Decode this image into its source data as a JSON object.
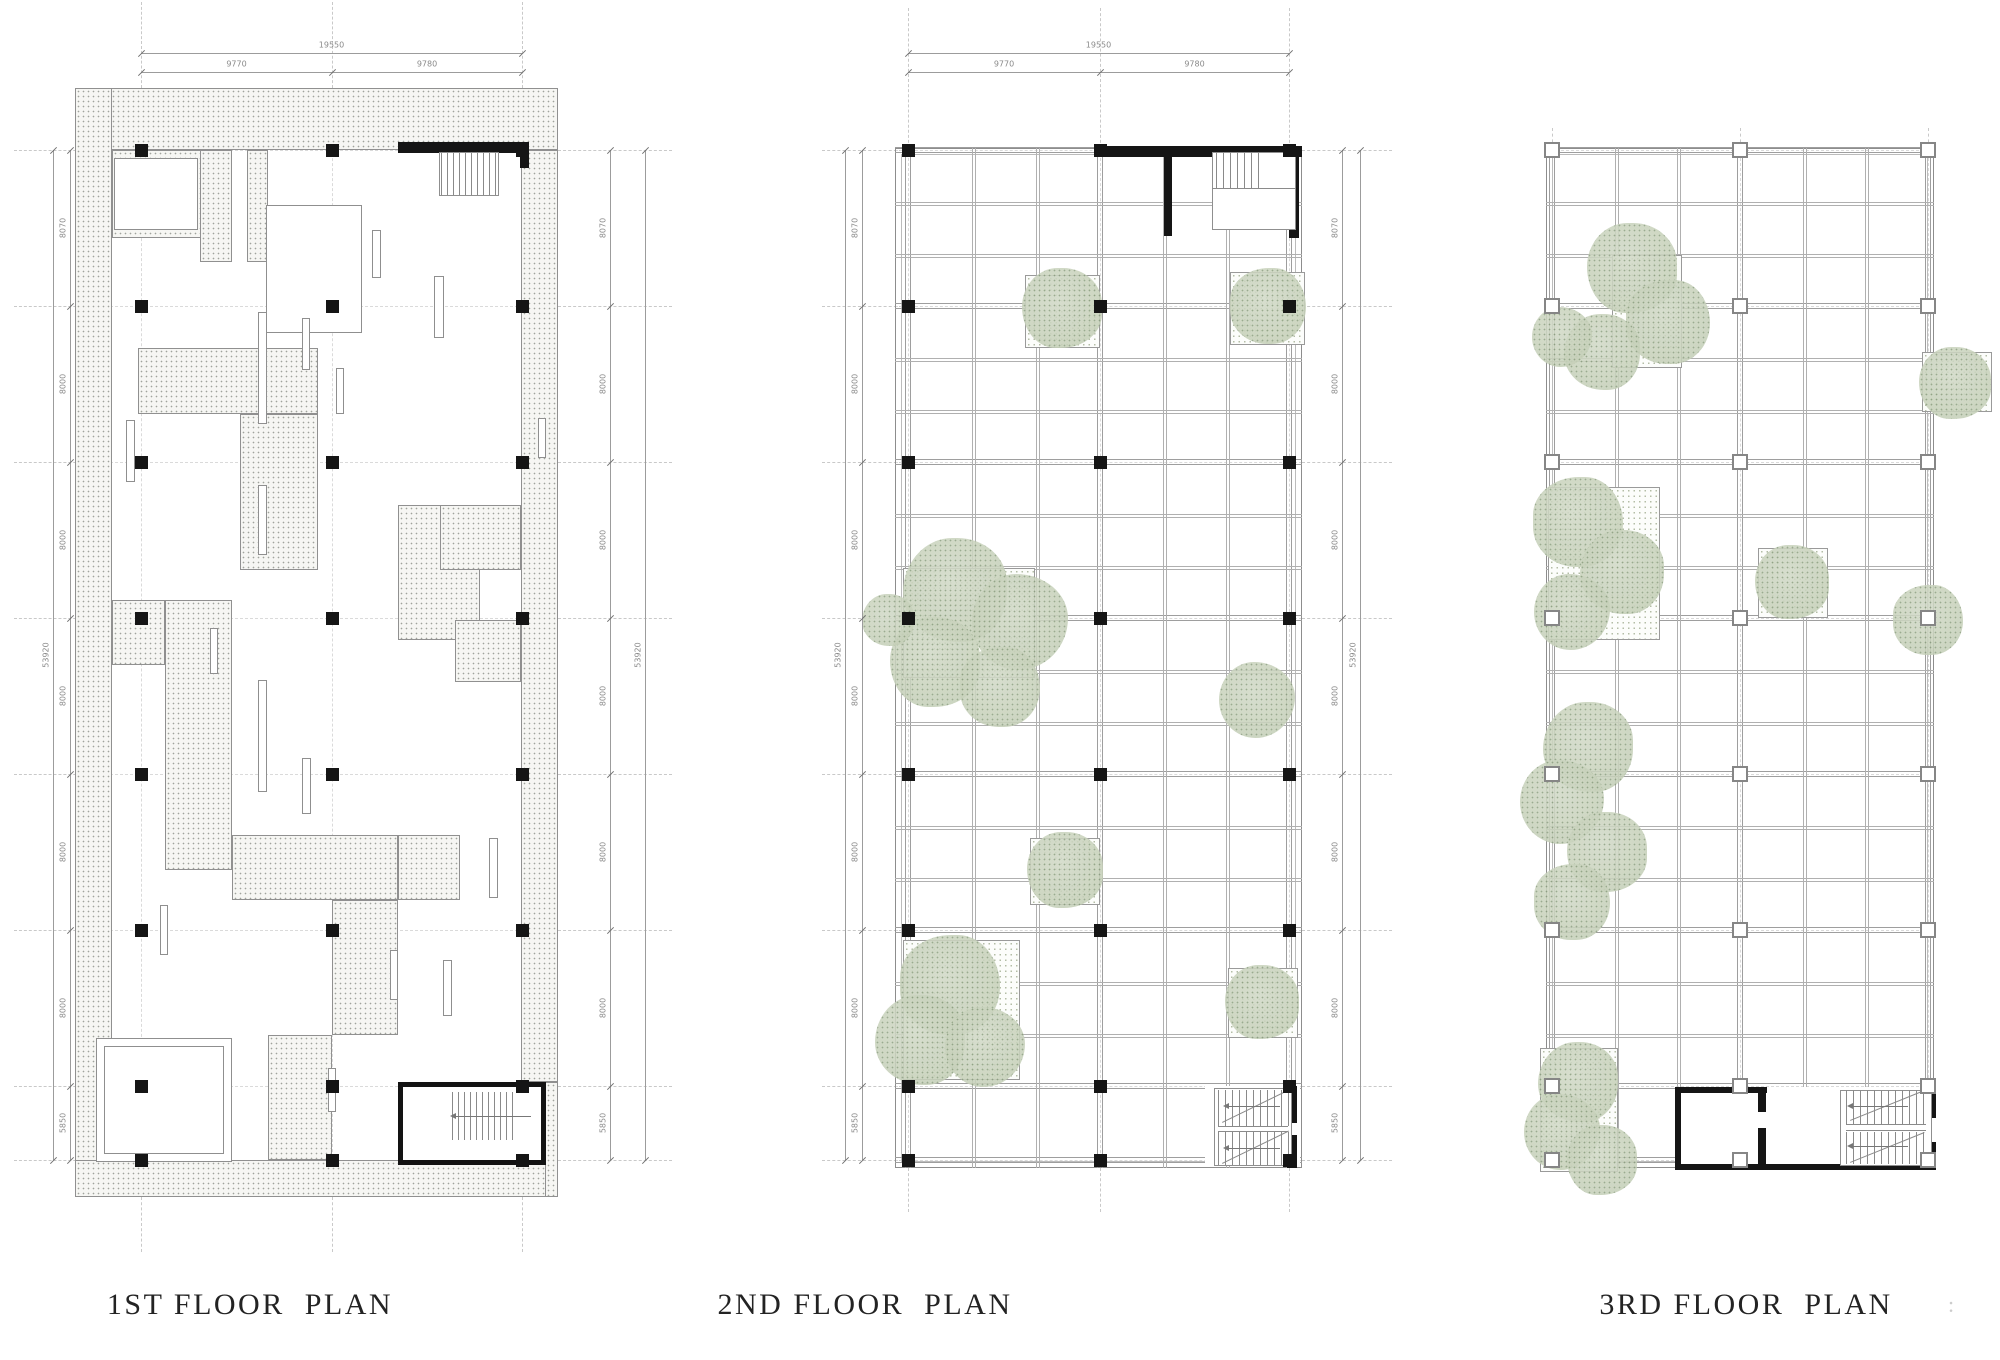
{
  "titles": {
    "first": "1ST FLOOR  PLAN",
    "second": "2ND FLOOR  PLAN",
    "third": "3RD FLOOR  PLAN"
  },
  "suffix": ":",
  "dims": {
    "top_total": "19550",
    "top_segments": [
      "9770",
      "9780"
    ],
    "side_total": "53920",
    "side_segments": [
      "8070",
      "8000",
      "8000",
      "8000",
      "8000",
      "8000",
      "5850"
    ]
  },
  "colors": {
    "line": "#9c9c9c",
    "beam": "#9e9e9e",
    "beam_light": "#b0b0b0",
    "dash": "#c9c9c9",
    "dash_inner": "#dadada",
    "dim_text": "#8a8a8a",
    "black": "#151515",
    "stair": "#8a8a8a",
    "tree_fill": "#c9d3bc",
    "tree_dot": "#8da081",
    "title": "#232323"
  },
  "geometry": {
    "rows": [
      150,
      306,
      462,
      618,
      774,
      930,
      1086,
      1160
    ],
    "plans": [
      {
        "name": "first-floor",
        "cols": [
          141,
          332,
          522
        ],
        "bld": [
          75,
          88,
          483,
          1109
        ],
        "style": "stipple",
        "colStyle": "solid",
        "topDims": true,
        "chains": [
          {
            "x": 53,
            "type": "total"
          },
          {
            "x": 70,
            "type": "chain"
          },
          {
            "x": 610,
            "type": "chain"
          },
          {
            "x": 645,
            "type": "total"
          }
        ],
        "rowDashL": [
          14,
          96
        ],
        "rowDashR": [
          558,
          672
        ],
        "colDashT": [
          2,
          88
        ],
        "colDashB": [
          1197,
          1252
        ],
        "stipple": [
          [
            75,
            88,
            483,
            62
          ],
          [
            75,
            88,
            37,
            1109
          ],
          [
            75,
            1160,
            483,
            37
          ],
          [
            521,
            150,
            37,
            932
          ],
          [
            112,
            150,
            93,
            88
          ],
          [
            200,
            150,
            32,
            112
          ],
          [
            247,
            150,
            21,
            112
          ],
          [
            138,
            348,
            180,
            66
          ],
          [
            240,
            414,
            78,
            156
          ],
          [
            398,
            505,
            82,
            135
          ],
          [
            440,
            505,
            81,
            65
          ],
          [
            165,
            600,
            67,
            270
          ],
          [
            112,
            600,
            53,
            65
          ],
          [
            232,
            835,
            166,
            65
          ],
          [
            332,
            900,
            66,
            135
          ],
          [
            398,
            835,
            62,
            65
          ],
          [
            455,
            620,
            66,
            62
          ],
          [
            268,
            1035,
            64,
            125
          ],
          [
            545,
            1082,
            13,
            115
          ]
        ],
        "rooms": [
          [
            114,
            158,
            84,
            72
          ],
          [
            266,
            205,
            96,
            128
          ],
          [
            96,
            1038,
            136,
            124
          ],
          [
            104,
            1046,
            120,
            108
          ]
        ],
        "slots": [
          [
            126,
            420,
            9,
            62
          ],
          [
            258,
            312,
            9,
            112
          ],
          [
            258,
            485,
            9,
            70
          ],
          [
            258,
            680,
            9,
            112
          ],
          [
            302,
            758,
            9,
            56
          ],
          [
            372,
            230,
            9,
            48
          ],
          [
            434,
            276,
            10,
            62
          ],
          [
            210,
            628,
            8,
            46
          ],
          [
            336,
            368,
            8,
            46
          ],
          [
            489,
            838,
            9,
            60
          ],
          [
            443,
            960,
            9,
            56
          ],
          [
            328,
            1068,
            8,
            44
          ],
          [
            160,
            905,
            8,
            50
          ],
          [
            390,
            950,
            8,
            50
          ],
          [
            538,
            418,
            8,
            40
          ],
          [
            302,
            318,
            8,
            52
          ]
        ],
        "black": [
          [
            398,
            142,
            131,
            11
          ],
          [
            520,
            142,
            9,
            26
          ]
        ],
        "stairRooms": [
          [
            398,
            1082,
            148,
            83
          ]
        ],
        "stairOutlines": [
          [
            439,
            152,
            60,
            44
          ]
        ],
        "treads": [
          {
            "x": 441,
            "y": 153,
            "w": 54,
            "h": 42,
            "step": 6
          },
          {
            "x": 452,
            "y": 1092,
            "w": 64,
            "h": 48,
            "step": 6
          }
        ],
        "arrows": [
          [
            455,
            1116,
            76
          ]
        ]
      },
      {
        "name": "second-floor",
        "cols": [
          908,
          1100,
          1289
        ],
        "bld": [
          895,
          148,
          407,
          1020
        ],
        "style": "frame",
        "colStyle": "solid",
        "topDims": true,
        "chains": [
          {
            "x": 845,
            "type": "total"
          },
          {
            "x": 862,
            "type": "chain"
          },
          {
            "x": 1342,
            "type": "chain"
          },
          {
            "x": 1360,
            "type": "total"
          }
        ],
        "rowDashL": [
          822,
          902
        ],
        "rowDashR": [
          1302,
          1392
        ],
        "colDashT": [
          8,
          148
        ],
        "colDashB": [
          1168,
          1212
        ],
        "whiteBase": [
          [
            1205,
            1086,
            95,
            80
          ]
        ],
        "black": [
          [
            1096,
            146,
            206,
            11
          ],
          [
            1289,
            146,
            10,
            92
          ],
          [
            1164,
            146,
            8,
            90
          ],
          [
            1287,
            1086,
            10,
            37
          ],
          [
            1287,
            1135,
            10,
            33
          ]
        ],
        "stairRooms": [],
        "stairOutlines": [
          [
            1212,
            152,
            84,
            78
          ],
          [
            1214,
            1088,
            78,
            78
          ]
        ],
        "treads": [
          {
            "x": 1216,
            "y": 152,
            "w": 44,
            "h": 36,
            "step": 7
          },
          {
            "x": 1218,
            "y": 1090,
            "w": 70,
            "h": 36,
            "step": 7
          },
          {
            "x": 1218,
            "y": 1132,
            "w": 70,
            "h": 33,
            "step": 7
          }
        ],
        "hlines": [
          [
            1212,
            1296,
            188
          ],
          [
            1218,
            1288,
            1126
          ],
          [
            1218,
            1288,
            1131
          ]
        ],
        "diags": [
          [
            1222,
            1122,
            74,
            -26
          ],
          [
            1222,
            1163,
            74,
            -26
          ]
        ],
        "arrows": [
          [
            1228,
            1106,
            52
          ],
          [
            1228,
            1148,
            52
          ]
        ],
        "beds": [
          [
            1025,
            275,
            75,
            73
          ],
          [
            1230,
            272,
            75,
            73
          ],
          [
            903,
            568,
            132,
            110
          ],
          [
            1030,
            838,
            70,
            67
          ],
          [
            903,
            940,
            117,
            140
          ],
          [
            1228,
            968,
            70,
            70
          ]
        ],
        "trees": [
          [
            1062,
            308,
            40
          ],
          [
            1268,
            306,
            38
          ],
          [
            955,
            590,
            52
          ],
          [
            1020,
            622,
            48
          ],
          [
            935,
            662,
            45
          ],
          [
            1000,
            687,
            40
          ],
          [
            888,
            620,
            26
          ],
          [
            1257,
            700,
            38
          ],
          [
            1065,
            870,
            38
          ],
          [
            950,
            985,
            50
          ],
          [
            920,
            1040,
            45
          ],
          [
            985,
            1047,
            40
          ],
          [
            1262,
            1002,
            37
          ]
        ]
      },
      {
        "name": "third-floor",
        "cols": [
          1552,
          1740,
          1928
        ],
        "bld": [
          1546,
          148,
          388,
          1020
        ],
        "style": "frame",
        "colStyle": "hollow",
        "topDims": false,
        "chains": [],
        "colDashT": [
          128,
          148
        ],
        "whiteBase": [
          [
            1675,
            1087,
            260,
            83
          ]
        ],
        "black": [
          [
            1675,
            1087,
            92,
            6
          ],
          [
            1675,
            1087,
            6,
            83
          ],
          [
            1675,
            1164,
            261,
            6
          ],
          [
            1758,
            1090,
            8,
            22
          ],
          [
            1758,
            1128,
            8,
            40
          ],
          [
            1929,
            1090,
            7,
            28
          ],
          [
            1929,
            1142,
            7,
            26
          ]
        ],
        "stairRooms": [],
        "stairOutlines": [
          [
            1840,
            1090,
            92,
            76
          ]
        ],
        "treads": [
          {
            "x": 1846,
            "y": 1090,
            "w": 80,
            "h": 34,
            "step": 7
          },
          {
            "x": 1846,
            "y": 1132,
            "w": 80,
            "h": 32,
            "step": 7
          }
        ],
        "hlines": [
          [
            1846,
            1926,
            1124
          ],
          [
            1846,
            1926,
            1130
          ]
        ],
        "diags": [
          [
            1850,
            1120,
            80,
            -22
          ],
          [
            1850,
            1162,
            80,
            -22
          ]
        ],
        "arrows": [
          [
            1852,
            1106,
            56
          ],
          [
            1852,
            1146,
            56
          ]
        ],
        "beds": [
          [
            1612,
            255,
            70,
            113
          ],
          [
            1922,
            352,
            70,
            60
          ],
          [
            1548,
            487,
            112,
            153
          ],
          [
            1758,
            548,
            70,
            70
          ],
          [
            1540,
            1048,
            78,
            124
          ]
        ],
        "trees": [
          [
            1632,
            268,
            45
          ],
          [
            1668,
            322,
            42
          ],
          [
            1602,
            352,
            38
          ],
          [
            1562,
            337,
            30
          ],
          [
            1955,
            383,
            36
          ],
          [
            1578,
            522,
            45
          ],
          [
            1622,
            572,
            42
          ],
          [
            1572,
            612,
            38
          ],
          [
            1792,
            582,
            37
          ],
          [
            1928,
            620,
            35
          ],
          [
            1588,
            747,
            45
          ],
          [
            1562,
            802,
            42
          ],
          [
            1607,
            852,
            40
          ],
          [
            1572,
            902,
            38
          ],
          [
            1578,
            1082,
            40
          ],
          [
            1562,
            1132,
            38
          ],
          [
            1602,
            1160,
            35
          ]
        ]
      }
    ]
  }
}
